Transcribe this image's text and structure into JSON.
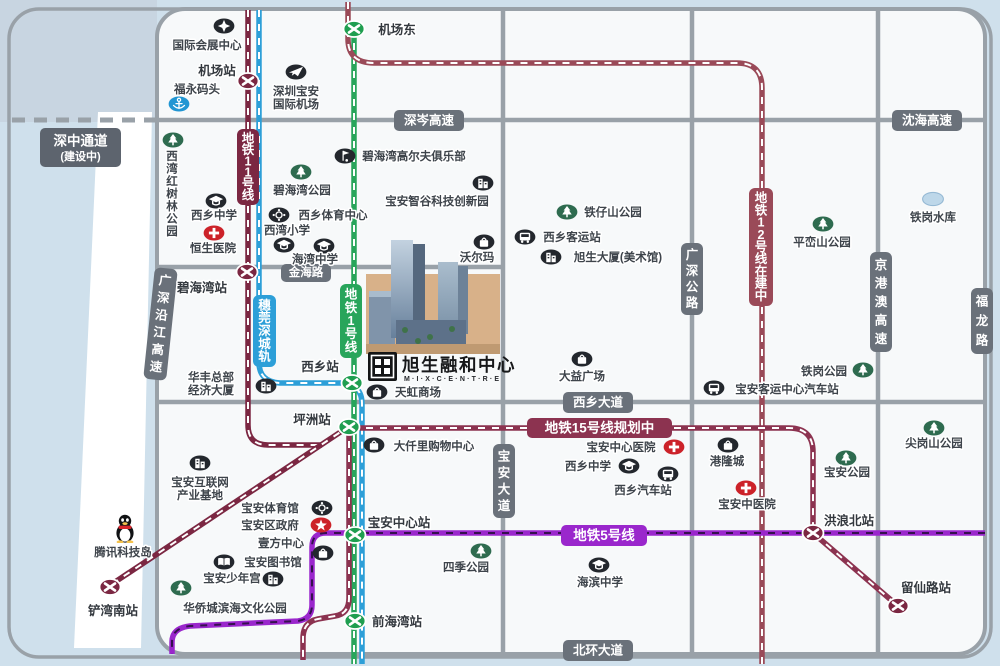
{
  "map": {
    "width": 1000,
    "height": 666,
    "colors": {
      "water": "#cfe0ec",
      "water_corner": "#c8d5e1",
      "land": "#f7f9fa",
      "wedge": "#ffffff",
      "road": "#99a1a8",
      "road_label_bg": "#6a717a",
      "dark_label_bg": "#5d646e",
      "text": "#3e444b",
      "station_text": "#33383e",
      "line11": "#7b2742",
      "line12": "#9a4a58",
      "line15": "#8c3350",
      "line1": "#28a55b",
      "rail": "#2d9fd8",
      "line5": "#9a27cc",
      "line5_dash": "#35104e",
      "white": "#ffffff",
      "poi_dark": "#23272d",
      "poi_green": "#2e6b4f",
      "poi_red": "#cc2229",
      "poi_blue": "#2196d3",
      "reservoir_fill": "#bdd7e9",
      "reservoir_stroke": "#95b9d4",
      "tan": "#d8b189",
      "tan_base": "#bf9a72"
    },
    "channel": {
      "label_lines": [
        "深中通道",
        "(建设中)"
      ],
      "box": {
        "x": 40,
        "y": 128,
        "w": 81,
        "h": 39
      }
    },
    "roads": {
      "paths": [
        "M 157,120 H 984",
        "M 157,267 H 503",
        "M 157,402 H 984",
        "M 503,9 V 654",
        "M 692,9 V 654",
        "M 878,9 V 654"
      ],
      "h_labels": [
        {
          "slug": "shencen-expwy",
          "label": "深岑高速",
          "x": 394,
          "y": 110,
          "w": 70,
          "h": 21
        },
        {
          "slug": "shenhai-expwy",
          "label": "沈海高速",
          "x": 892,
          "y": 110,
          "w": 70,
          "h": 21
        },
        {
          "slug": "jinhai-road",
          "label": "金海路",
          "x": 281,
          "y": 264,
          "w": 50,
          "h": 18
        },
        {
          "slug": "xixiang-avenue",
          "label": "西乡大道",
          "x": 563,
          "y": 392,
          "w": 70,
          "h": 21
        },
        {
          "slug": "beihuan-avenue",
          "label": "北环大道",
          "x": 563,
          "y": 640,
          "w": 70,
          "h": 21
        }
      ],
      "v_labels": [
        {
          "slug": "baoan-avenue",
          "label": "宝安大道",
          "x": 493,
          "y": 444,
          "w": 22,
          "h": 74
        },
        {
          "slug": "guangshen-highway",
          "label": "广深公路",
          "x": 681,
          "y": 243,
          "w": 22,
          "h": 72
        },
        {
          "slug": "jinggangao-expwy",
          "label": "京港澳高速",
          "x": 870,
          "y": 252,
          "w": 22,
          "h": 100
        },
        {
          "slug": "fulong-road",
          "label": "福龙路",
          "x": 971,
          "y": 288,
          "w": 22,
          "h": 66
        },
        {
          "slug": "guangshen-coastal-expwy",
          "label": "广深沿江高速",
          "x": 149,
          "y": 268,
          "w": 23,
          "h": 112,
          "rotate": 6
        }
      ]
    },
    "metro_lines": [
      {
        "slug": "line11",
        "label": "地铁11号线",
        "color_key": "line11",
        "dash_key": "white",
        "paths": [
          "M 248,10 V 425 Q 248,445 268,445 H 322",
          "M 351,425 L 112,584"
        ],
        "label_box": {
          "x": 237,
          "y": 129,
          "w": 22,
          "h": 76,
          "vertical": true
        }
      },
      {
        "slug": "suwanshen-rail",
        "label": "穗莞深城轨",
        "color_key": "rail",
        "dash_key": "white",
        "paths": [
          "M 259,10 V 362 Q 259,382 280,383 H 341 Q 362,384 362,404 V 664"
        ],
        "label_box": {
          "x": 253,
          "y": 295,
          "w": 23,
          "h": 72,
          "vertical": true
        }
      },
      {
        "slug": "line1",
        "label": "地铁1号线",
        "color_key": "line1",
        "dash_key": "white",
        "paths": [
          "M 354,29 V 664"
        ],
        "label_box": {
          "x": 340,
          "y": 284,
          "w": 22,
          "h": 74,
          "vertical": true
        }
      },
      {
        "slug": "line12",
        "label": "地铁12号线在建中",
        "color_key": "line12",
        "dash_key": "white",
        "paths": [
          "M 348,2 V 39 Q 348,63 374,63 H 737 Q 762,63 762,88 V 664"
        ],
        "label_box": {
          "x": 749,
          "y": 188,
          "w": 24,
          "h": 118,
          "vertical": true
        }
      },
      {
        "slug": "line15",
        "label": "地铁15号线规划中",
        "color_key": "line15",
        "dash_key": "white",
        "paths": [
          "M 352,428 H 789 Q 813,428 813,452 V 533 L 898,606",
          "M 349,427 V 598 Q 349,614 335,616 L 318,619 Q 303,622 303,638 V 660"
        ],
        "label_box": {
          "x": 527,
          "y": 418,
          "w": 145,
          "h": 20,
          "vertical": false
        }
      },
      {
        "slug": "line5",
        "label": "地铁5号线",
        "color_key": "line5",
        "dash_key": "line5_dash",
        "paths": [
          "M 985,533 H 326 Q 312,533 312,547 V 605 Q 312,619 298,621 L 190,626 Q 172,628 172,642 V 654"
        ],
        "label_box": {
          "x": 561,
          "y": 525,
          "w": 86,
          "h": 21,
          "vertical": false
        }
      }
    ],
    "stations": [
      {
        "slug": "jichangdong",
        "label": "机场东",
        "x": 354,
        "y": 29,
        "line": "line1",
        "lx": 397,
        "ly": 34
      },
      {
        "slug": "jichangzhan",
        "label": "机场站",
        "x": 248,
        "y": 81,
        "line": "line11",
        "lx": 217,
        "ly": 75
      },
      {
        "slug": "bihaiwanzhan",
        "label": "碧海湾站",
        "x": 247,
        "y": 272,
        "line": "line11",
        "lx": 202,
        "ly": 292
      },
      {
        "slug": "xixiangzhan",
        "label": "西乡站",
        "x": 352,
        "y": 383,
        "line": "line1",
        "lx": 320,
        "ly": 371
      },
      {
        "slug": "pingzhouzhan",
        "label": "坪洲站",
        "x": 349,
        "y": 427,
        "line": "line1",
        "lx": 312,
        "ly": 424
      },
      {
        "slug": "baoan-zhongxin-zhan",
        "label": "宝安中心站",
        "x": 355,
        "y": 535,
        "line": "line1",
        "lx": 399,
        "ly": 527
      },
      {
        "slug": "qianhaiwanzhan",
        "label": "前海湾站",
        "x": 355,
        "y": 621,
        "line": "line1",
        "lx": 397,
        "ly": 626
      },
      {
        "slug": "chanwannanzhan",
        "label": "铲湾南站",
        "x": 110,
        "y": 587,
        "line": "line11",
        "lx": 113,
        "ly": 615
      },
      {
        "slug": "honglangbeizhan",
        "label": "洪浪北站",
        "x": 813,
        "y": 533,
        "line": "line11",
        "lx": 849,
        "ly": 525
      },
      {
        "slug": "liuxianluzhan",
        "label": "留仙路站",
        "x": 898,
        "y": 606,
        "line": "line11",
        "lx": 926,
        "ly": 592
      }
    ],
    "pois": [
      {
        "slug": "intl-convention-center",
        "icon": "star",
        "x": 224,
        "y": 26,
        "label": "国际会展中心",
        "lx": 207,
        "ly": 49
      },
      {
        "slug": "fuyong-wharf",
        "icon": "anchor",
        "x": 179,
        "y": 104,
        "label": "福永码头",
        "lx": 197,
        "ly": 93
      },
      {
        "slug": "shenzhen-baoan-airport",
        "icon": "plane",
        "x": 296,
        "y": 72,
        "label": [
          "深圳宝安",
          "国际机场"
        ],
        "lx": 296,
        "ly": 95
      },
      {
        "slug": "xiwan-mangrove-park",
        "icon": "tree",
        "x": 173,
        "y": 140,
        "label": "西湾红树林公园",
        "lx": 172,
        "ly": 160,
        "vertical": true
      },
      {
        "slug": "xixiang-middle-school",
        "icon": "school",
        "x": 216,
        "y": 201,
        "label": "西乡中学",
        "lx": 214,
        "ly": 219
      },
      {
        "slug": "hengsheng-hospital",
        "icon": "hospital",
        "x": 214,
        "y": 233,
        "label": "恒生医院",
        "lx": 213,
        "ly": 252
      },
      {
        "slug": "bihaiwan-park",
        "icon": "tree",
        "x": 301,
        "y": 172,
        "label": "碧海湾公园",
        "lx": 302,
        "ly": 194
      },
      {
        "slug": "xixiang-sports-center",
        "icon": "sports",
        "x": 279,
        "y": 215,
        "label": "西乡体育中心",
        "lx": 333,
        "ly": 219
      },
      {
        "slug": "xiwan-primary-school",
        "icon": "school",
        "x": 284,
        "y": 245,
        "label": "西湾小学",
        "lx": 287,
        "ly": 234
      },
      {
        "slug": "haiwan-middle-school",
        "icon": "school",
        "x": 324,
        "y": 246,
        "label": "海湾中学",
        "lx": 315,
        "ly": 263
      },
      {
        "slug": "bihaiwan-golf-club",
        "icon": "golf",
        "x": 345,
        "y": 156,
        "label": "碧海湾高尔夫俱乐部",
        "lx": 414,
        "ly": 160
      },
      {
        "slug": "baoan-zhigu-tech-park",
        "icon": "building",
        "x": 483,
        "y": 183,
        "label": "宝安智谷科技创新园",
        "lx": 437,
        "ly": 205
      },
      {
        "slug": "walmart",
        "icon": "shop",
        "x": 484,
        "y": 242,
        "label": "沃尔玛",
        "lx": 477,
        "ly": 261
      },
      {
        "slug": "tiezaishan-park",
        "icon": "tree",
        "x": 567,
        "y": 212,
        "label": "铁仔山公园",
        "lx": 613,
        "ly": 216
      },
      {
        "slug": "xixiang-passenger-station",
        "icon": "bus",
        "x": 525,
        "y": 237,
        "label": "西乡客运站",
        "lx": 572,
        "ly": 241
      },
      {
        "slug": "xusheng-tower-art-museum",
        "icon": "building",
        "x": 551,
        "y": 257,
        "label": "旭生大厦(美术馆)",
        "lx": 618,
        "ly": 261
      },
      {
        "slug": "dayi-plaza",
        "icon": "shop",
        "x": 582,
        "y": 359,
        "label": "大益广场",
        "lx": 582,
        "ly": 380
      },
      {
        "slug": "huafeng-hq-building",
        "icon": "building",
        "x": 266,
        "y": 386,
        "label": [
          "华丰总部",
          "经济大厦"
        ],
        "lx": 211,
        "ly": 381
      },
      {
        "slug": "tianhong-mall",
        "icon": "shop",
        "x": 377,
        "y": 392,
        "label": "天虹商场",
        "lx": 418,
        "ly": 396
      },
      {
        "slug": "daqianli-mall",
        "icon": "shop",
        "x": 374,
        "y": 445,
        "label": "大仟里购物中心",
        "lx": 434,
        "ly": 450
      },
      {
        "slug": "baoan-internet-base",
        "icon": "building",
        "x": 200,
        "y": 463,
        "label": [
          "宝安互联网",
          "产业基地"
        ],
        "lx": 200,
        "ly": 486
      },
      {
        "slug": "tencent-tech-island",
        "icon": "qq",
        "x": 125,
        "y": 528,
        "label": "腾讯科技岛",
        "lx": 123,
        "ly": 556
      },
      {
        "slug": "baoan-gymnasium",
        "icon": "sports",
        "x": 322,
        "y": 508,
        "label": "宝安体育馆",
        "lx": 270,
        "ly": 512
      },
      {
        "slug": "baoan-district-gov",
        "icon": "gov",
        "x": 321,
        "y": 525,
        "label": "宝安区政府",
        "lx": 270,
        "ly": 529
      },
      {
        "slug": "yifang-center",
        "icon": "shop",
        "x": 323,
        "y": 553,
        "label": "壹方中心",
        "lx": 281,
        "ly": 547
      },
      {
        "slug": "baoan-library",
        "icon": "book",
        "x": 224,
        "y": 562,
        "label": "宝安图书馆",
        "lx": 273,
        "ly": 566
      },
      {
        "slug": "baoan-youth-palace",
        "icon": "building",
        "x": 273,
        "y": 579,
        "label": "宝安少年宫",
        "lx": 232,
        "ly": 582
      },
      {
        "slug": "oct-binhai-culture-park",
        "icon": "tree",
        "x": 181,
        "y": 588,
        "label": "华侨城滨海文化公园",
        "lx": 235,
        "ly": 612
      },
      {
        "slug": "siji-park",
        "icon": "tree",
        "x": 481,
        "y": 551,
        "label": "四季公园",
        "lx": 466,
        "ly": 571
      },
      {
        "slug": "haibin-middle-school",
        "icon": "school",
        "x": 599,
        "y": 565,
        "label": "海滨中学",
        "lx": 600,
        "ly": 586
      },
      {
        "slug": "baoan-central-hospital",
        "icon": "hospital",
        "x": 674,
        "y": 447,
        "label": "宝安中心医院",
        "lx": 621,
        "ly": 451
      },
      {
        "slug": "xixiang-middle-school-2",
        "icon": "school",
        "x": 629,
        "y": 466,
        "label": "西乡中学",
        "lx": 588,
        "ly": 470
      },
      {
        "slug": "xixiang-bus-station",
        "icon": "bus",
        "x": 668,
        "y": 474,
        "label": "西乡汽车站",
        "lx": 643,
        "ly": 494
      },
      {
        "slug": "ganglong-city",
        "icon": "shop",
        "x": 728,
        "y": 445,
        "label": "港隆城",
        "lx": 727,
        "ly": 465
      },
      {
        "slug": "baoan-tcm-hospital",
        "icon": "hospital",
        "x": 746,
        "y": 488,
        "label": "宝安中医院",
        "lx": 747,
        "ly": 508
      },
      {
        "slug": "baoan-passenger-center-station",
        "icon": "bus",
        "x": 714,
        "y": 388,
        "label": "宝安客运中心汽车站",
        "lx": 787,
        "ly": 393
      },
      {
        "slug": "tiegang-park",
        "icon": "tree",
        "x": 863,
        "y": 370,
        "label": "铁岗公园",
        "lx": 824,
        "ly": 375
      },
      {
        "slug": "baoan-park",
        "icon": "tree",
        "x": 846,
        "y": 458,
        "label": "宝安公园",
        "lx": 847,
        "ly": 476
      },
      {
        "slug": "pingluanshan-park",
        "icon": "tree",
        "x": 823,
        "y": 224,
        "label": "平峦山公园",
        "lx": 822,
        "ly": 246
      },
      {
        "slug": "tiegang-reservoir",
        "icon": "reservoir",
        "x": 933,
        "y": 199,
        "label": "铁岗水库",
        "lx": 933,
        "ly": 221
      },
      {
        "slug": "jiangangshan-park",
        "icon": "tree",
        "x": 934,
        "y": 428,
        "label": "尖岗山公园",
        "lx": 934,
        "ly": 447
      }
    ],
    "project": {
      "name": "旭生融和中心",
      "latin": "M·I·X·C·E·N·T·R·E"
    }
  }
}
